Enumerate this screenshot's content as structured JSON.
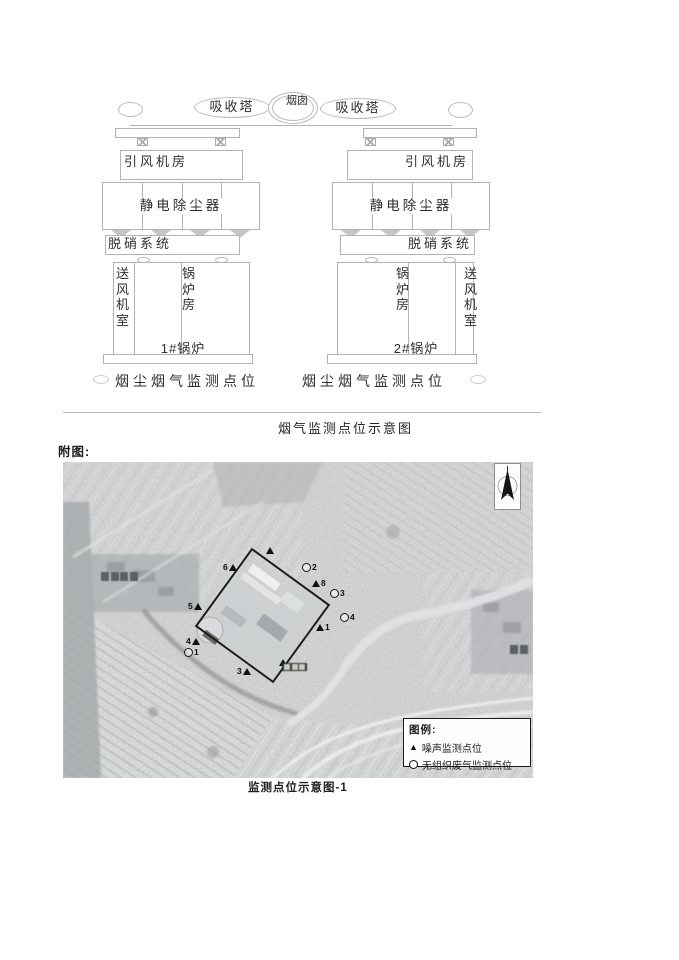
{
  "colors": {
    "ink": "#2e2e2e",
    "diagram_line": "#b3b3b3",
    "map_marker": "#111111",
    "boundary": "#1c1c1c"
  },
  "document": {
    "figure1_caption": "烟气监测点位示意图",
    "attachment_label": "附图:",
    "figure2_caption": "监测点位示意图-1"
  },
  "diagram": {
    "chimney": "烟囱",
    "absorber_left": "吸收塔",
    "absorber_right": "吸收塔",
    "left_unit": {
      "fan_room": "引风机房",
      "esp": "静电除尘器",
      "denox": "脱硝系统",
      "supply_fan_room": "送风机室",
      "boiler_house": "锅炉房",
      "boiler_name": "1#锅炉",
      "monitor_label": "烟尘烟气监测点位"
    },
    "right_unit": {
      "fan_room": "引风机房",
      "esp": "静电除尘器",
      "denox": "脱硝系统",
      "supply_fan_room": "送风机室",
      "boiler_house": "锅炉房",
      "boiler_name": "2#锅炉",
      "monitor_label": "烟尘烟气监测点位"
    }
  },
  "map": {
    "legend": {
      "title": "图例:",
      "noise_symbol": "▲",
      "noise_label": "噪声监测点位",
      "gas_symbol": "○",
      "gas_label": "无组织废气监测点位"
    },
    "point_labels": {
      "n1": "1",
      "n3": "3",
      "n4": "4",
      "n5": "5",
      "n6": "6",
      "n8": "8",
      "g1": "1",
      "g2": "2",
      "g3": "3",
      "g4": "4"
    }
  }
}
